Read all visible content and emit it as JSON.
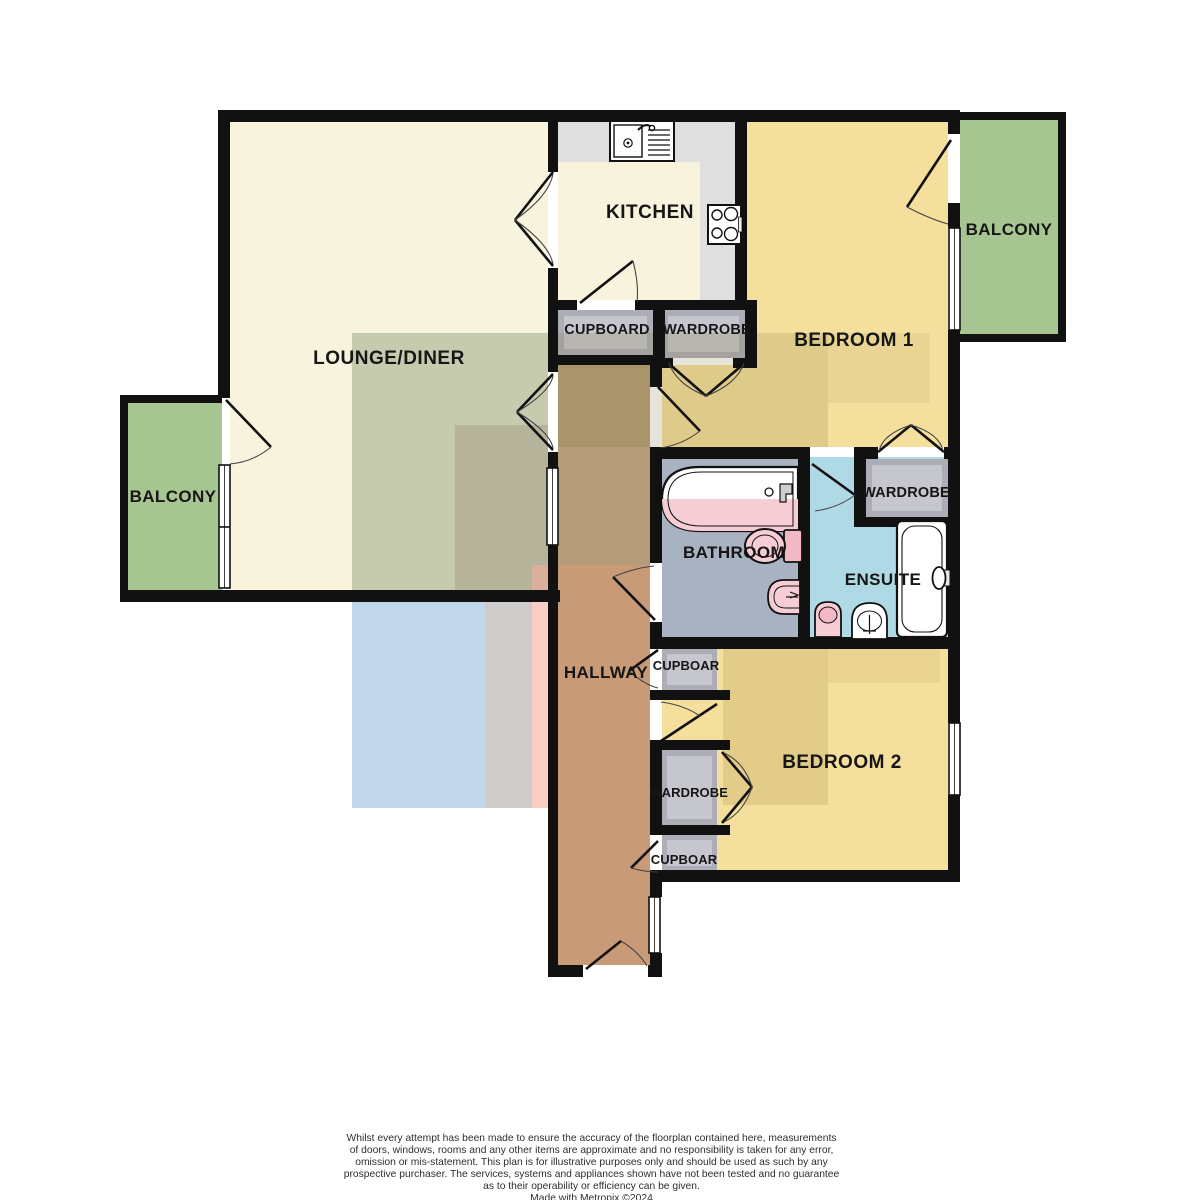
{
  "labels": {
    "lounge": "LOUNGE/DINER",
    "kitchen": "KITCHEN",
    "bedroom1": "BEDROOM 1",
    "bedroom2": "BEDROOM 2",
    "bathroom": "BATHROOM",
    "ensuite": "ENSUITE",
    "hallway": "HALLWAY",
    "balcony_left": "BALCONY",
    "balcony_right": "BALCONY",
    "cupboard_top": "CUPBOARD",
    "wardrobe_top": "WARDROBE",
    "wardrobe_ensuite": "WARDROBE",
    "cupboard_hall": "CUPBOAR",
    "wardrobe_bedroom2": "WARDROBE",
    "cupboard_bottom": "CUPBOAR"
  },
  "colors": {
    "wall": "#111111",
    "room_cream": "#F8F3DD",
    "bedroom_yellow": "#F5DF9D",
    "balcony_green": "#A6C591",
    "bathroom_blue": "#A8B2C1",
    "ensuite_blue": "#AFD9E5",
    "hallway_brown": "#B49C78",
    "storage_gray": "#ACADB7",
    "storage_gray_light": "#C6C6CE",
    "counter_gray": "#DFDFDF",
    "fixture_pink": "#F7CDD5",
    "fixture_pink_dark": "#F2B9C4"
  },
  "footer": {
    "lines": [
      "Whilst every attempt has been made to ensure the accuracy of the floorplan contained here, measurements",
      "of doors, windows, rooms and any other items are approximate and no responsibility is taken for any error,",
      "omission or mis-statement. This plan is for illustrative purposes only and should be used as such by any",
      "prospective purchaser. The services, systems and appliances shown have not been tested and no guarantee",
      "as to their operability or efficiency can be given.",
      "Made with Metropix ©2024"
    ]
  }
}
